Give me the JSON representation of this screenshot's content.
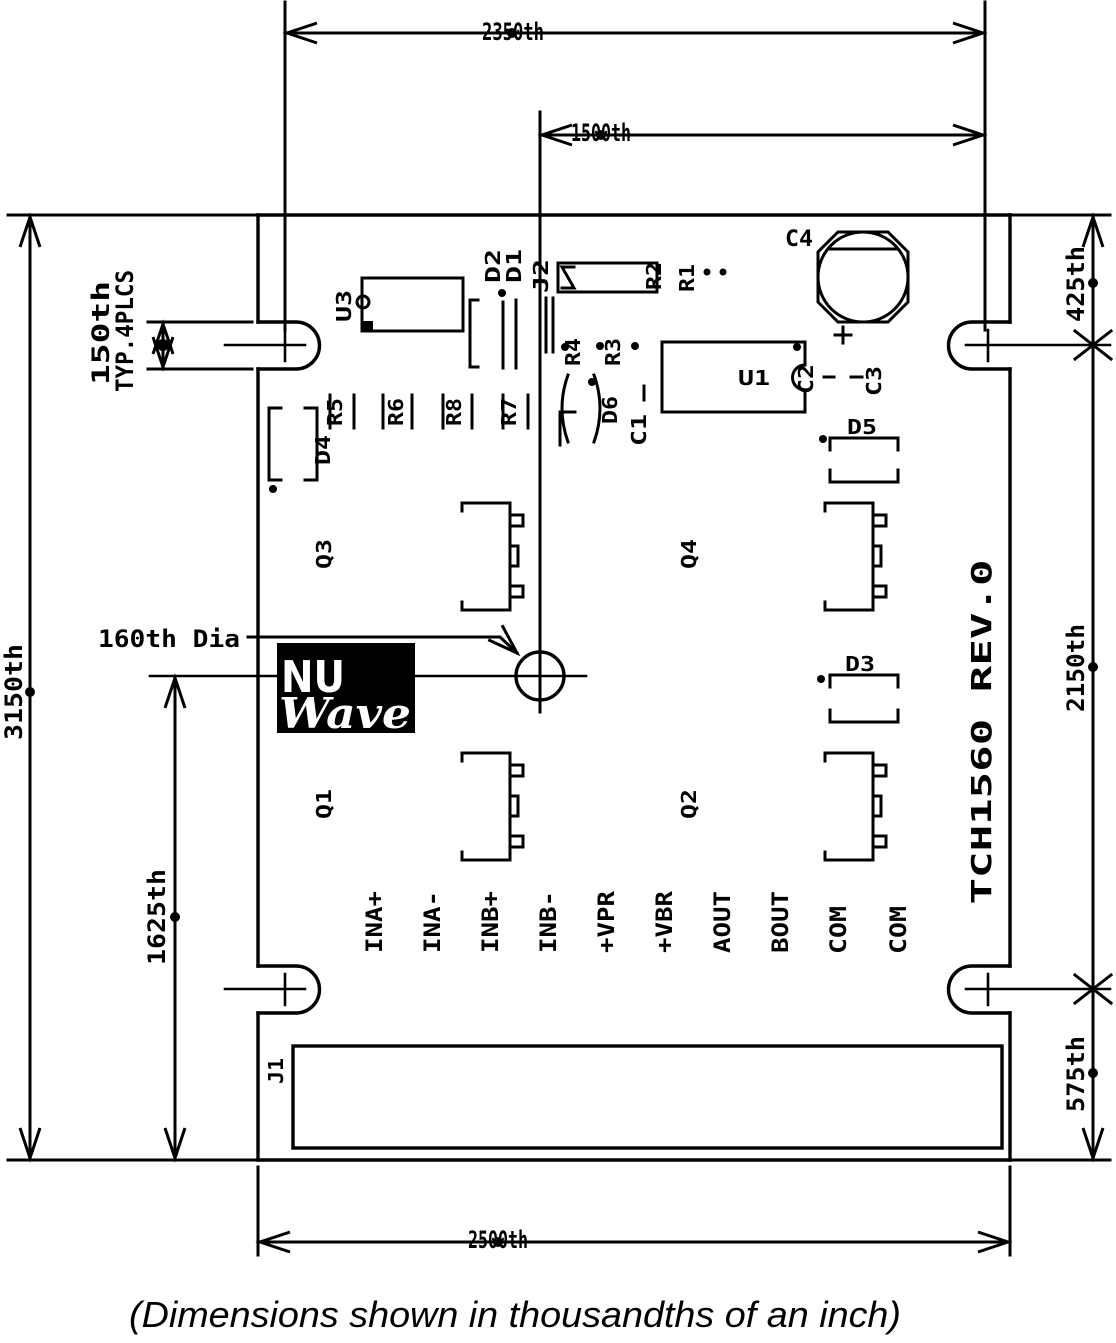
{
  "title": "PCB dimensional drawing",
  "board_id": "TCH1560 REV.0",
  "caption": "(Dimensions shown in thousandths of an inch)",
  "colors": {
    "line": "#000000",
    "background": "#ffffff",
    "logo_bg": "#000000",
    "logo_text": "#ffffff"
  },
  "dimensions": {
    "top_outer": "2350th",
    "top_inner": "1500th",
    "left_outer": "3150th",
    "left_inner": "1625th",
    "right_top": "425th",
    "right_middle": "2150th",
    "right_bottom": "575th",
    "bottom": "2500th",
    "slot_width_line1": "150th",
    "slot_width_line2": "TYP.4PLCS",
    "hole_note": "160th Dia"
  },
  "refdes": {
    "c4": "C4",
    "u3": "U3",
    "d2": "D2",
    "d1": "D1",
    "j2": "J2",
    "r2": "R2",
    "r1": "R1",
    "r4": "R4",
    "r3": "R3",
    "u1": "U1",
    "c2": "C2",
    "c3": "C3",
    "r5": "R5",
    "r6": "R6",
    "r8": "R8",
    "r7": "R7",
    "d4": "D4",
    "d6": "D6",
    "c1": "C1",
    "d5": "D5",
    "d3": "D3",
    "q3": "Q3",
    "q4": "Q4",
    "q1": "Q1",
    "q2": "Q2",
    "j1": "J1"
  },
  "pins": [
    "INA+",
    "INA-",
    "INB+",
    "INB-",
    "+VPR",
    "+VBR",
    "AOUT",
    "BOUT",
    "COM",
    "COM"
  ],
  "logo": {
    "top": "NU",
    "script": "Wave"
  }
}
